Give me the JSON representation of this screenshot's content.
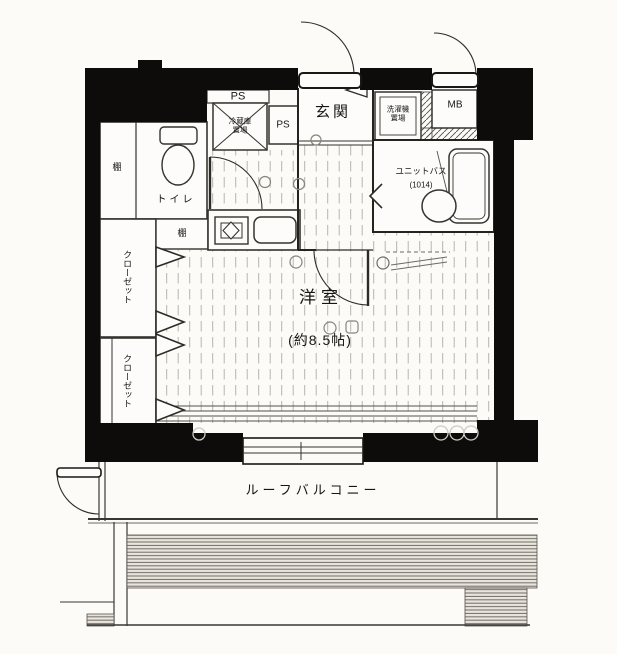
{
  "floorplan": {
    "labels": {
      "ps_top": "PS",
      "ps_side": "PS",
      "entrance": "玄関",
      "fridge_l1": "冷蔵庫",
      "fridge_l2": "置場",
      "laundry_l1": "洗濯機",
      "laundry_l2": "置場",
      "meter_box": "MB",
      "unit_bath": "ユニットバス",
      "unit_bath_size": "(1014)",
      "toilet": "トイレ",
      "shelf_toilet": "棚",
      "shelf_hall": "棚",
      "closet_upper": "クローゼット",
      "closet_lower": "クローゼット",
      "room": "洋室",
      "room_size": "(約8.5帖)",
      "balcony": "ルーフバルコニー"
    },
    "colors": {
      "wall": "#0d0c0a",
      "line": "#36332e",
      "floor_line": "#b9b4aa",
      "paper": "#fcfbf8",
      "hatch": "#6f6a62"
    }
  }
}
